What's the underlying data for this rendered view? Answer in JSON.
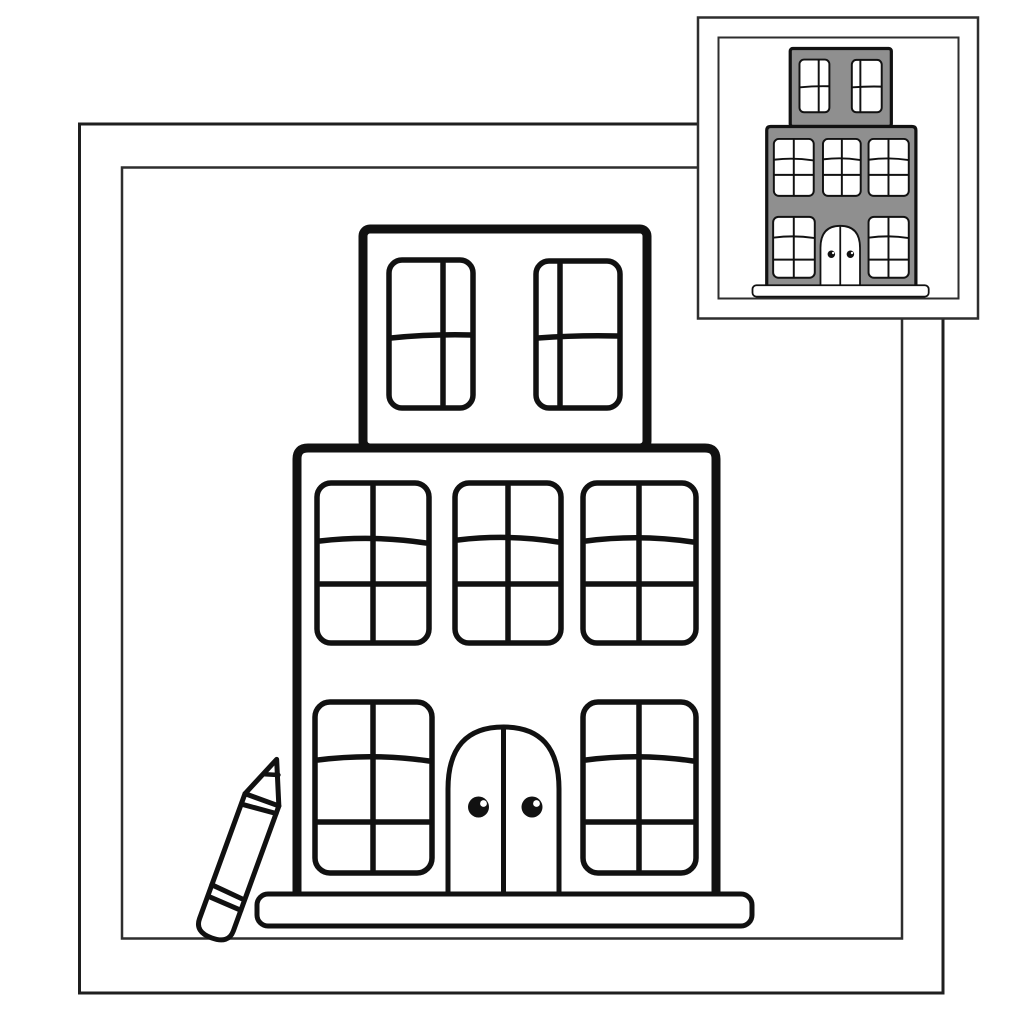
{
  "page": {
    "kind": "coloring book page",
    "subject": "Outline drawing of a three-story building with paneled windows, an arched double door, and a pencil leaning against its left side",
    "background_color": "#ffffff",
    "outline_color": "#111111"
  },
  "frame": {
    "style": "double rectangular border around the coloring area",
    "outer_border_color": "#1f1f1f",
    "inner_border_color": "#2e2e2e"
  },
  "building": {
    "fill_color": "#ffffff",
    "floors": [
      {
        "label": "top floor",
        "windows": 2,
        "panes_per_window": 4
      },
      {
        "label": "middle floor",
        "windows": 3,
        "panes_per_window": 6
      },
      {
        "label": "ground floor",
        "windows": 2,
        "panes_per_window": 6
      }
    ],
    "door": {
      "shape": "arched double door",
      "knob_count": 2,
      "knob_color": "#111111"
    },
    "base": "rounded pedestal"
  },
  "pencil": {
    "position": "leaning against building, bottom left",
    "tilt_degrees": 20,
    "fill_color": "#ffffff"
  },
  "reference_thumbnail": {
    "position": "top right corner",
    "description": "small colored example of the same building",
    "style": "double border panel",
    "border_color": "#2e2e2e",
    "background_color": "#ffffff",
    "building_fill": "#8f8f8f",
    "window_fill": "#ffffff",
    "door_fill": "#ffffff"
  }
}
